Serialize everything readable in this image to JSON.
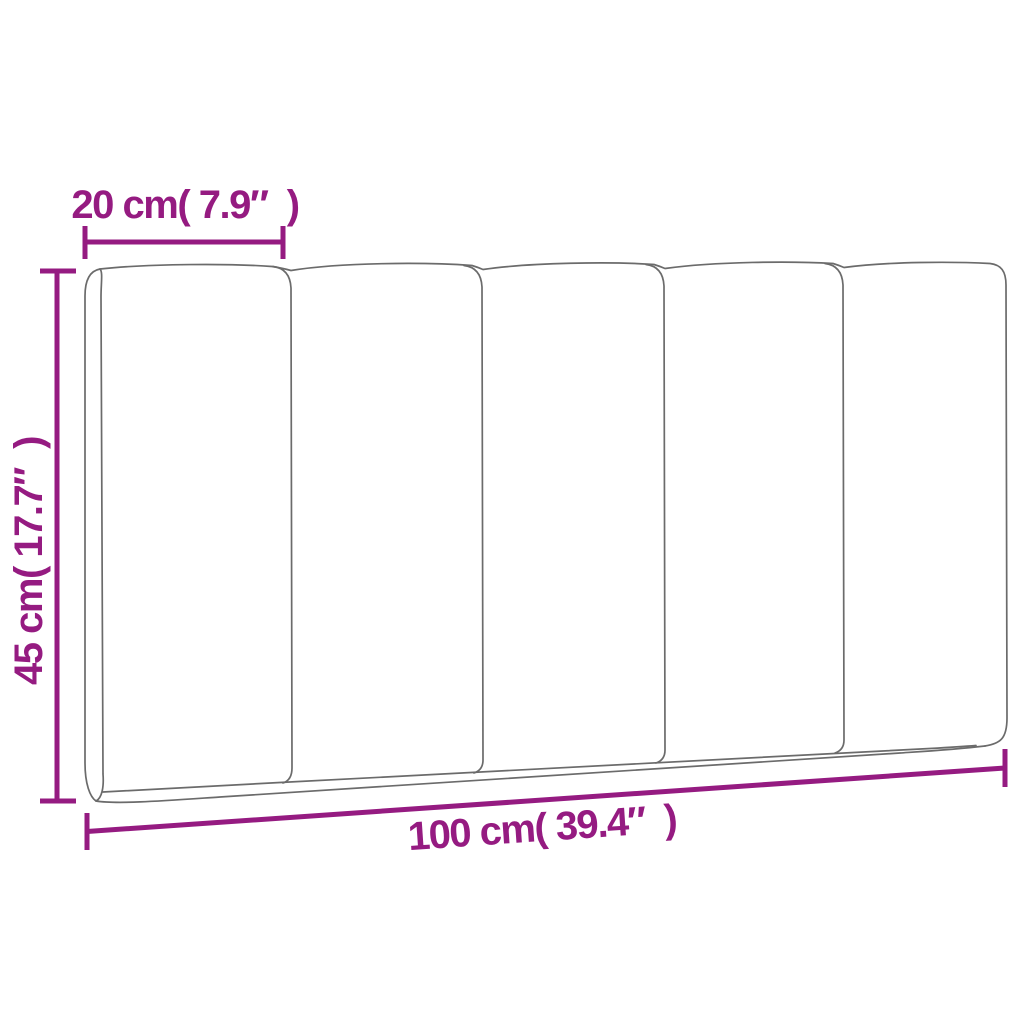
{
  "diagram": {
    "kind": "product-dimension-diagram",
    "product": {
      "type": "headboard-cushion",
      "panel_count": 5
    },
    "colors": {
      "dimension_accent": "#951b81",
      "outline_gray": "#6b6b6b",
      "background": "#ffffff"
    },
    "dimensions": {
      "panel_width": {
        "label": "20 cm( 7.9″  )",
        "value_cm": 20,
        "value_in": 7.9
      },
      "height": {
        "label": "45 cm( 17.7″  )",
        "value_cm": 45,
        "value_in": 17.7
      },
      "total_width": {
        "label": "100 cm( 39.4″  )",
        "value_cm": 100,
        "value_in": 39.4
      }
    }
  }
}
